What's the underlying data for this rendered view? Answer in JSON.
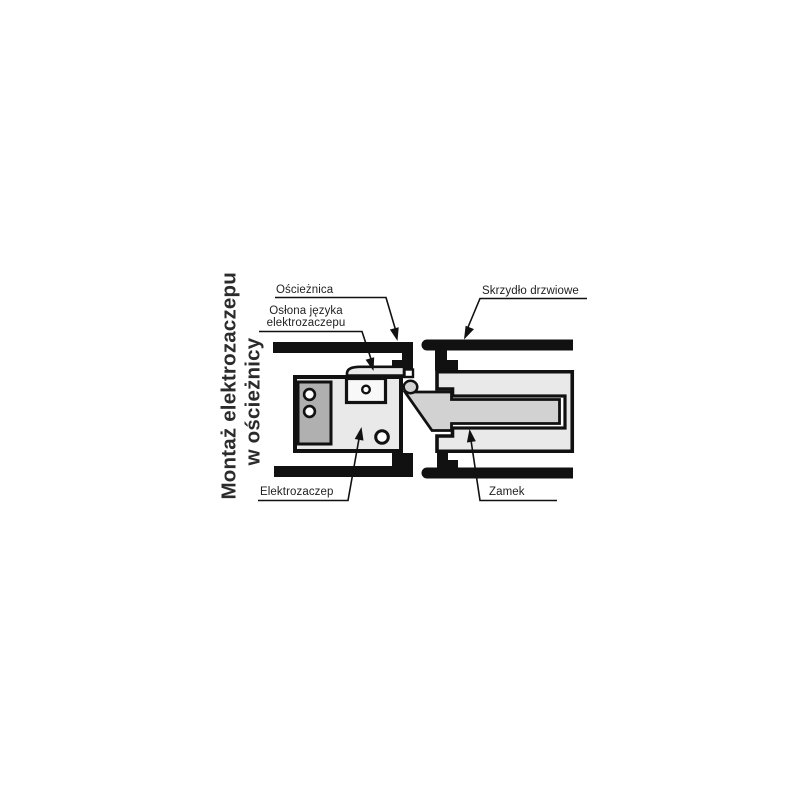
{
  "title": {
    "line1": "Montaż elektrozaczepu",
    "line2": "w ościeżnicy"
  },
  "labels": {
    "frame": "Ościeżnica",
    "cover_line1": "Osłona języka",
    "cover_line2": "elektrozaczepu",
    "door_leaf": "Skrzydło drzwiowe",
    "strike": "Elektrozaczep",
    "lock": "Zamek"
  },
  "colors": {
    "outline": "#111111",
    "light_fill": "#e9e9e9",
    "mid_fill": "#d2d2d2",
    "dark_fill": "#b0b0b0",
    "chamber_fill": "#f8f8f8",
    "hole_fill": "#ffffff",
    "text": "#1f1f1f"
  }
}
